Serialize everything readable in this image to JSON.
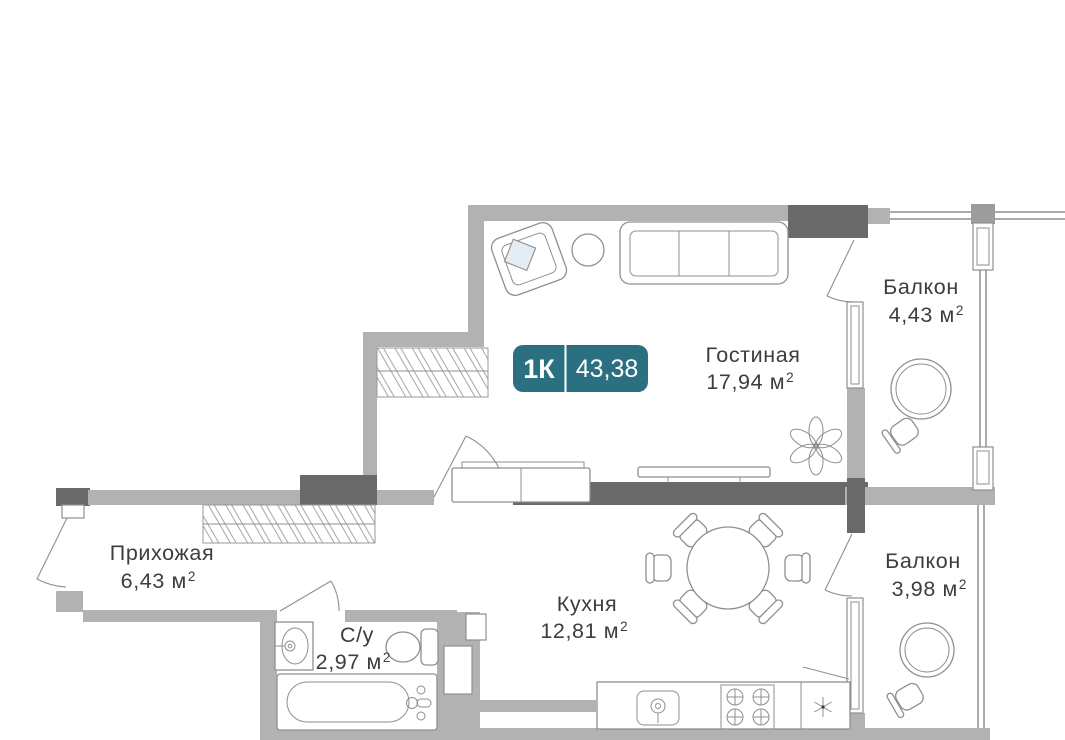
{
  "plan": {
    "badge": {
      "rooms_label": "1К",
      "total_area": "43,38"
    },
    "rooms": {
      "living": {
        "name": "Гостиная",
        "area": "17,94 м",
        "sup": "2"
      },
      "balcony_top": {
        "name": "Балкон",
        "area": "4,43 м",
        "sup": "2"
      },
      "balcony_bottom": {
        "name": "Балкон",
        "area": "3,98 м",
        "sup": "2"
      },
      "hallway": {
        "name": "Прихожая",
        "area": "6,43 м",
        "sup": "2"
      },
      "kitchen": {
        "name": "Кухня",
        "area": "12,81 м",
        "sup": "2"
      },
      "bathroom": {
        "name": "С/у",
        "area": "2,97 м",
        "sup": "2"
      }
    },
    "colors": {
      "wall-light": "#b2b2b2",
      "wall-mid": "#9c9c9c",
      "wall-dark": "#696969",
      "outline": "#8f8f8f",
      "text": "#3d3d3d",
      "badge": "#2a7080"
    }
  }
}
